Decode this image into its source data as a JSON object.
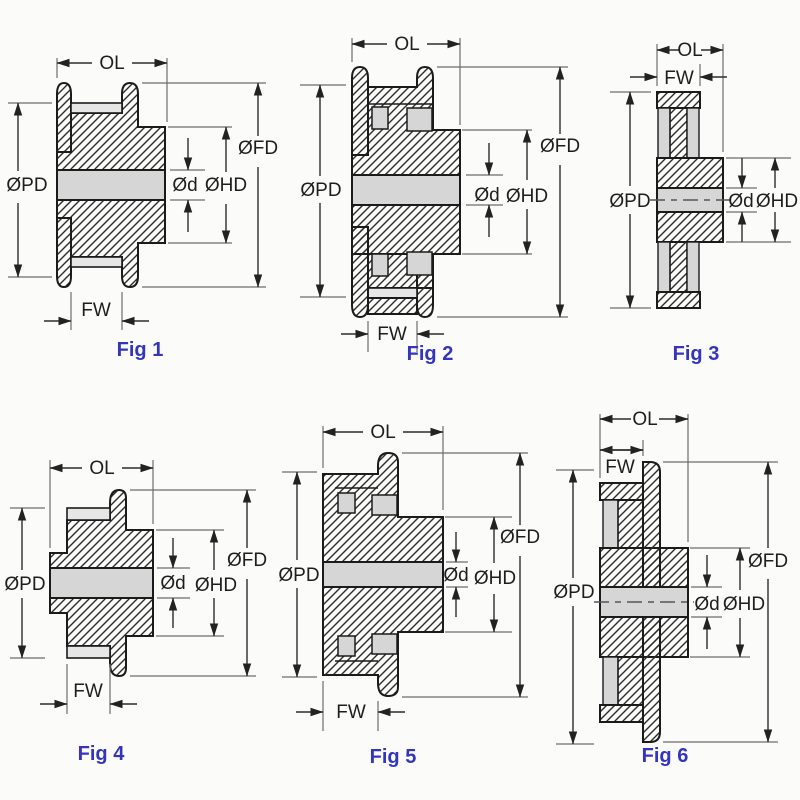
{
  "sheet": {
    "description": "Timing pulley cross-section dimension drawings",
    "colors": {
      "caption_blue": "#3434bd",
      "outline": "#1b1b1b",
      "dimension_line": "#2d2d2d",
      "light_gray_fill": "#d6d6d6",
      "background": "#fbfbfa"
    }
  },
  "figures": [
    {
      "caption": "Fig 1",
      "labels": {
        "ol": "OL",
        "fw": "FW",
        "pd": "ØPD",
        "fd": "ØFD",
        "hd": "ØHD",
        "d": "Ød"
      }
    },
    {
      "caption": "Fig 2",
      "labels": {
        "ol": "OL",
        "fw": "FW",
        "pd": "ØPD",
        "fd": "ØFD",
        "hd": "ØHD",
        "d": "Ød"
      }
    },
    {
      "caption": "Fig 3",
      "labels": {
        "ol": "OL",
        "fw": "FW",
        "pd": "ØPD",
        "hd": "ØHD",
        "d": "Ød"
      }
    },
    {
      "caption": "Fig 4",
      "labels": {
        "ol": "OL",
        "fw": "FW",
        "pd": "ØPD",
        "fd": "ØFD",
        "hd": "ØHD",
        "d": "Ød"
      }
    },
    {
      "caption": "Fig 5",
      "labels": {
        "ol": "OL",
        "fw": "FW",
        "pd": "ØPD",
        "fd": "ØFD",
        "hd": "ØHD",
        "d": "Ød"
      }
    },
    {
      "caption": "Fig 6",
      "labels": {
        "ol": "OL",
        "fw": "FW",
        "pd": "ØPD",
        "fd": "ØFD",
        "hd": "ØHD",
        "d": "Ød"
      }
    }
  ]
}
